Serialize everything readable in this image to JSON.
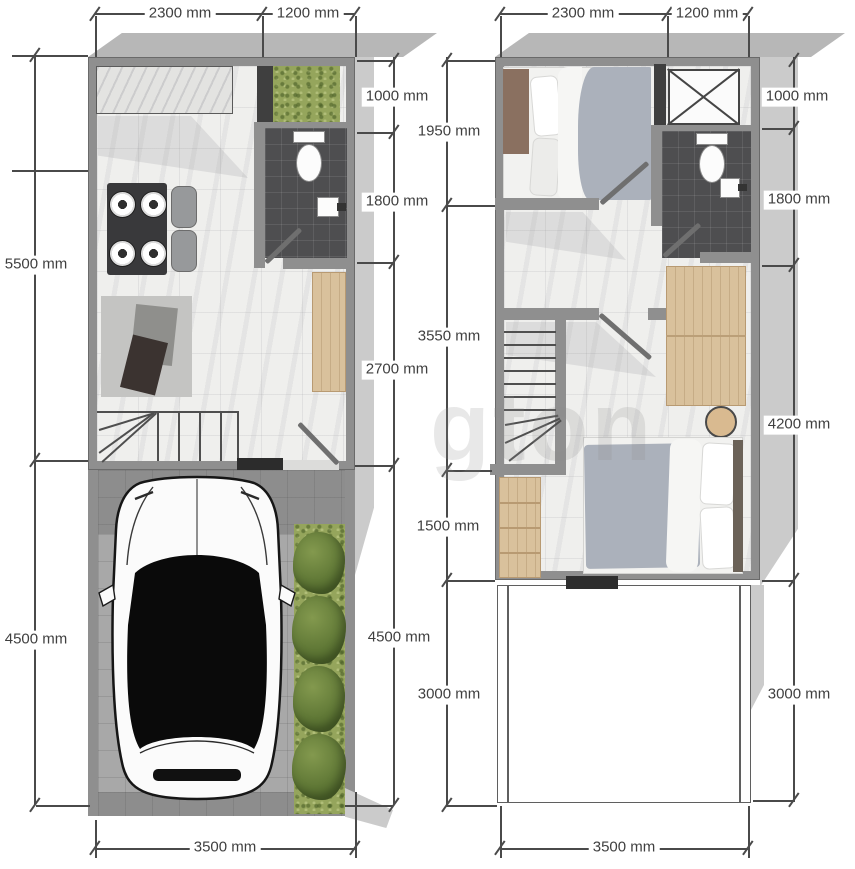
{
  "watermark": {
    "text": "gton"
  },
  "colors": {
    "wall": "#8f8f8f",
    "wall-dark": "#6a6a6a",
    "band": "#b7b7b7",
    "shadow": "#cbcbcb",
    "dim-line": "#4a4a4a",
    "dim-text": "#3f3f3f",
    "duvet": "#abb1bb",
    "headboard": "#8a7060",
    "wood": "#d9c19c",
    "grass": "#95a55c",
    "tile": "#4e4e50",
    "paving": "#a8a8a8",
    "table": "#39393b"
  },
  "plans": {
    "ground_floor": {
      "top_dims": [
        "2300 mm",
        "1200 mm"
      ],
      "left_dims": [
        "5500 mm",
        "4500 mm"
      ],
      "right_dims": [
        "1000 mm",
        "1800 mm",
        "2700 mm",
        "4500 mm"
      ],
      "bottom_dim": "3500 mm"
    },
    "upper_floor": {
      "top_dims": [
        "2300 mm",
        "1200 mm"
      ],
      "left_dims": [
        "1950 mm",
        "3550 mm",
        "1500 mm",
        "3000 mm"
      ],
      "right_dims": [
        "1000 mm",
        "1800 mm",
        "4200 mm",
        "3000 mm"
      ],
      "bottom_dim": "3500 mm"
    }
  }
}
